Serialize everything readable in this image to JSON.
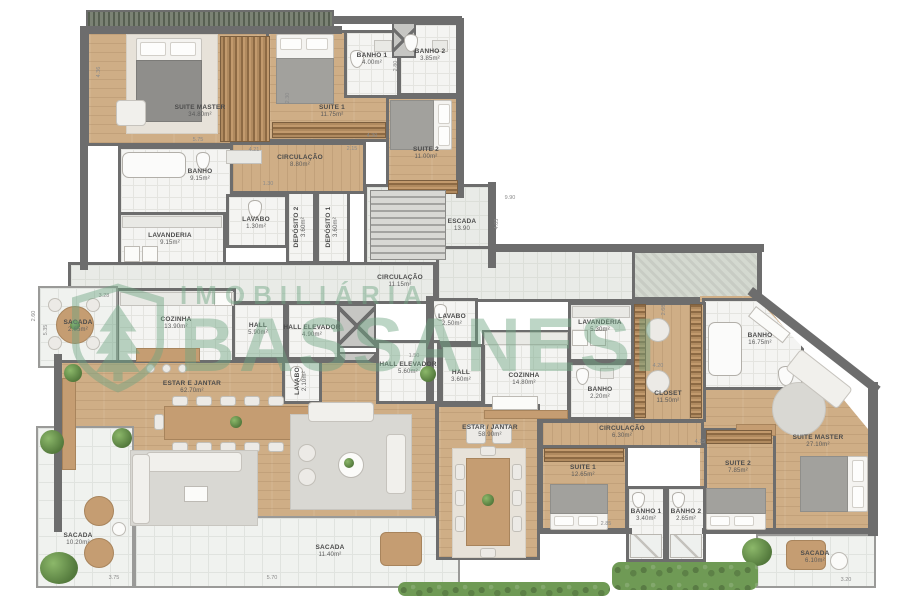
{
  "watermark": {
    "line1": "IMOBILIÁRIA",
    "line2": "BASSANESI",
    "logo": "shield-tree-icon",
    "color": "#6fa583"
  },
  "rooms": {
    "suite_master_a": {
      "name": "SUITE MASTER",
      "area": "34.80m²"
    },
    "suite1_a": {
      "name": "SUITE 1",
      "area": "11.75m²"
    },
    "banho1_a": {
      "name": "BANHO 1",
      "area": "4.00m²"
    },
    "banho2_a": {
      "name": "BANHO 2",
      "area": "3.85m²"
    },
    "suite2_a": {
      "name": "SUITE 2",
      "area": "11.00m²"
    },
    "banho_a": {
      "name": "BANHO",
      "area": "9.15m²"
    },
    "lavanderia_a": {
      "name": "LAVANDERIA",
      "area": "9.15m²"
    },
    "lavabo_a": {
      "name": "LAVABO",
      "area": "1.30m²"
    },
    "circulacao_a": {
      "name": "CIRCULAÇÃO",
      "area": "8.80m²"
    },
    "deposito2": {
      "name": "DEPÓSITO 2",
      "area": "3.60m²"
    },
    "deposito1": {
      "name": "DEPÓSITO 1",
      "area": "3.60m²"
    },
    "escada": {
      "name": "ESCADA",
      "area": "13.90"
    },
    "circulacao_main": {
      "name": "CIRCULAÇÃO",
      "area": "11.15m²"
    },
    "cozinha_a": {
      "name": "COZINHA",
      "area": "13.90m²"
    },
    "sacada_esq": {
      "name": "SACADA",
      "area": "2.65m²"
    },
    "hall_a": {
      "name": "HALL",
      "area": "5.90m²"
    },
    "hall_elevador_a": {
      "name": "HALL ELEVADOR",
      "area": "4.90m²"
    },
    "lavabo_a2": {
      "name": "LAVABO",
      "area": "2.10m²"
    },
    "estar_a": {
      "name": "ESTAR E JANTAR",
      "area": "62.70m²"
    },
    "sacada_a1": {
      "name": "SACADA",
      "area": "10.20m²"
    },
    "sacada_a2": {
      "name": "SACADA",
      "area": "11.40m²"
    },
    "hall_elevador_b": {
      "name": "HALL ELEVADOR",
      "area": "5.60m²"
    },
    "hall_b": {
      "name": "HALL",
      "area": "3.60m²"
    },
    "lavabo_b": {
      "name": "LAVABO",
      "area": "2.50m²"
    },
    "cozinha_b": {
      "name": "COZINHA",
      "area": "14.80m²"
    },
    "lavanderia_b": {
      "name": "LAVANDERIA",
      "area": "5.30m²"
    },
    "banho_b": {
      "name": "BANHO",
      "area": "2.20m²"
    },
    "closet_b": {
      "name": "CLOSET",
      "area": "11.50m²"
    },
    "banho_master_b": {
      "name": "BANHO",
      "area": "16.75m²"
    },
    "estar_b": {
      "name": "ESTAR / JANTAR",
      "area": "58.90m²"
    },
    "circulacao_b": {
      "name": "CIRCULAÇÃO",
      "area": "6.30m²"
    },
    "suite1_b": {
      "name": "SUITE 1",
      "area": "12.65m²"
    },
    "banho1_b": {
      "name": "BANHO 1",
      "area": "3.40m²"
    },
    "banho2_b": {
      "name": "BANHO 2",
      "area": "2.65m²"
    },
    "suite2_b": {
      "name": "SUITE 2",
      "area": "7.85m²"
    },
    "suite_master_b": {
      "name": "SUITE MASTER",
      "area": "27.10m²"
    },
    "sacada_b": {
      "name": "SACADA",
      "area": "6.10m²"
    }
  },
  "dims": [
    "4.36",
    "5.75",
    "4.21",
    "2.15",
    "2.80",
    "4.30",
    "2.30",
    "1.30",
    "9.90",
    "1.50",
    "2.68",
    "4.20",
    "4.15",
    "2.85",
    "3.28",
    "5.35",
    "3.75",
    "5.70",
    "3.20",
    "2.60",
    "4.03"
  ]
}
